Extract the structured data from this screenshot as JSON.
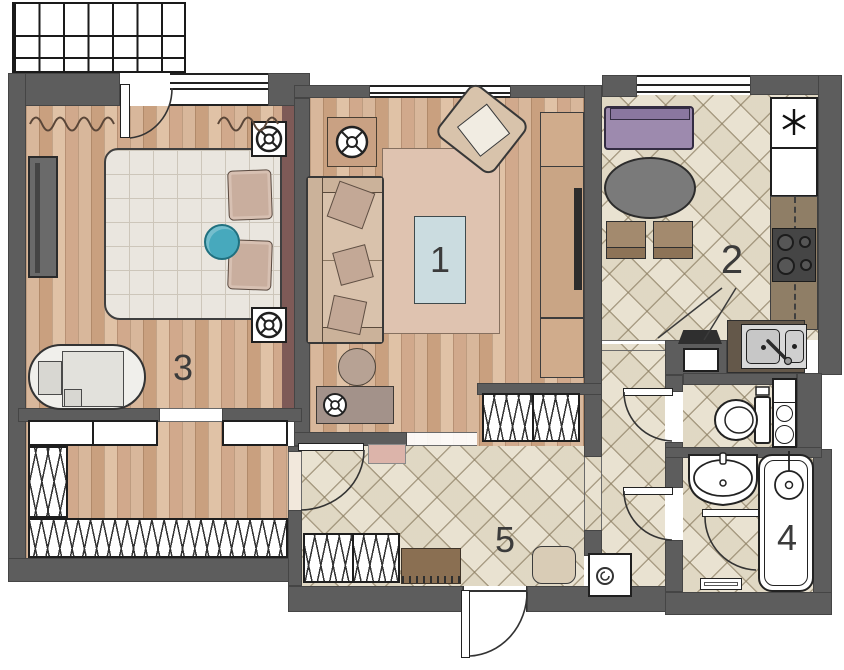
{
  "plan": {
    "type": "apartment-floor-plan",
    "rooms": [
      {
        "name": "living-room",
        "label": "1"
      },
      {
        "name": "kitchen",
        "label": "2"
      },
      {
        "name": "bedroom",
        "label": "3"
      },
      {
        "name": "bathroom",
        "label": "4"
      },
      {
        "name": "hallway",
        "label": "5"
      }
    ],
    "icons": [
      "snowflake-fridge-icon",
      "ceiling-speaker-icon",
      "round-tray-icon",
      "speaker-icon",
      "washer-drum-icon",
      "stove-burners-icon"
    ],
    "colors": {
      "wall": "#5d5d5d",
      "floor_a": "#d8b79b",
      "floor_b": "#c9a07f",
      "tile_bg": "#e9e2d1",
      "duvet": "#eae6df",
      "rug": "#dfc3b0",
      "table_blue": "#cbdce0",
      "sofa_tan": "#d9c2ac",
      "purple": "#9d8aae",
      "kitchen_table": "#7a7a7a",
      "chair_brown": "#a38a6e",
      "maroon": "#7e5a57",
      "teal": "#47a9bd",
      "counter": "#8f7e66",
      "counter_dark": "#64584a",
      "stand": "#a3928a",
      "cabinet": "#d0ac8c",
      "mat_brown": "#8a6f52",
      "pouf": "#d9ccb6",
      "pink_mat": "#dcb4aa",
      "label": "#3b3b3b"
    }
  }
}
